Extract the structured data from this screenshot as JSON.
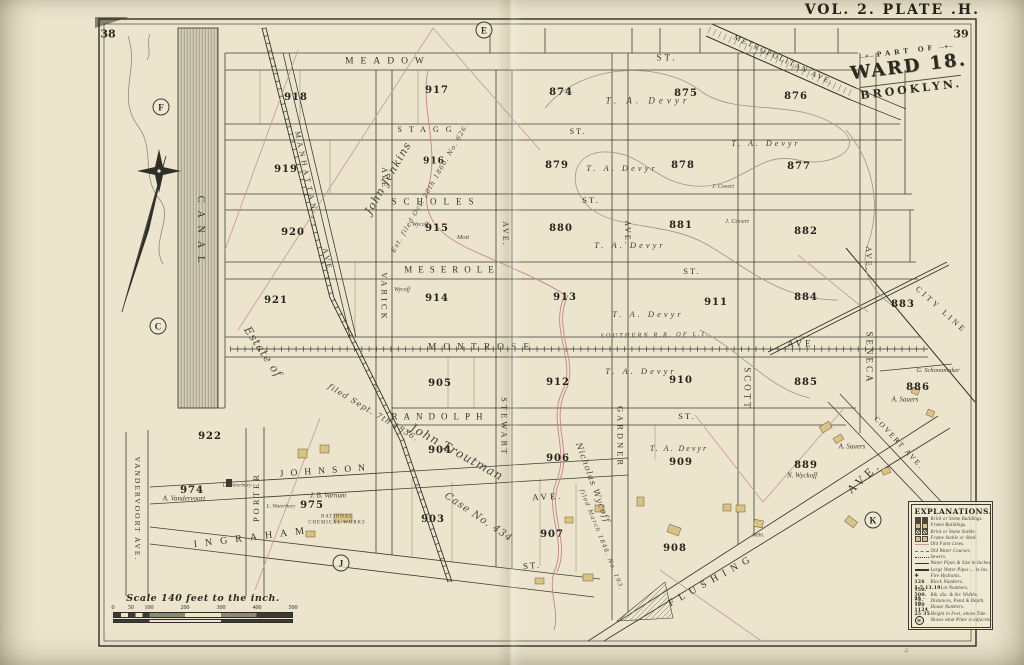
{
  "page": {
    "left_folio": "38",
    "right_folio": "39",
    "plate_title": "VOL. 2. PLATE .H.",
    "pencil_mark": "4"
  },
  "cartouche": {
    "part_of": "PART OF",
    "ward": "WARD 18.",
    "city": "BROOKLYN."
  },
  "scale_bar": {
    "label": "Scale 140 feet to the inch.",
    "ticks": [
      {
        "pos": 0,
        "t": "0"
      },
      {
        "pos": 10,
        "t": "50"
      },
      {
        "pos": 20,
        "t": "100"
      },
      {
        "pos": 40,
        "t": "200"
      },
      {
        "pos": 60,
        "t": "300"
      },
      {
        "pos": 80,
        "t": "400"
      },
      {
        "pos": 100,
        "t": "500"
      }
    ]
  },
  "explanations": {
    "title": "EXPLANATIONS.",
    "items": [
      {
        "sym": "brick",
        "label": "Brick or Stone Buildings."
      },
      {
        "sym": "frame",
        "label": "Frame Buildings."
      },
      {
        "sym": "brick-hatch",
        "label": "Brick or Stone Stable."
      },
      {
        "sym": "frame-hatch",
        "label": "Frame Stable or Shed."
      },
      {
        "sym": "farm",
        "label": "Old Farm Lines."
      },
      {
        "sym": "water",
        "label": "Old Water Courses."
      },
      {
        "sym": "sewer",
        "label": "Sewers."
      },
      {
        "sym": "pipe",
        "label": "Water Pipes & Size in Inches."
      },
      {
        "sym": "bigpipe",
        "label": "Large Water Pipes ... in Ins."
      },
      {
        "sym": "hydrant",
        "label": "Fire Hydrants."
      },
      {
        "sym": "text",
        "pre": "126",
        "label": "Block Numbers."
      },
      {
        "sym": "text",
        "pre": "5.7.13.19",
        "label": "Lot Numbers."
      },
      {
        "sym": "text",
        "pre": "150. 500. 75.",
        "label": "Blk. dia. & Str. Widths."
      },
      {
        "sym": "text",
        "pre": "25 · 10",
        "label": "Distances, Pond & Depth."
      },
      {
        "sym": "text",
        "pre": "120  1124",
        "label": "House Numbers."
      },
      {
        "sym": "text",
        "pre": "25  35",
        "label": "Height in Feet, above Tide."
      },
      {
        "sym": "plate",
        "pre": "H",
        "label": "Shows what Plate is adjacent."
      }
    ]
  },
  "plate_markers": [
    {
      "letter": "E",
      "x": 484,
      "y": 30
    },
    {
      "letter": "F",
      "x": 161,
      "y": 107
    },
    {
      "letter": "C",
      "x": 158,
      "y": 326
    },
    {
      "letter": "J",
      "x": 341,
      "y": 563
    },
    {
      "letter": "K",
      "x": 873,
      "y": 520
    }
  ],
  "map_labels": [
    {
      "t": "MEADOW",
      "x": 388,
      "y": 62,
      "s": 9.5,
      "ls": 7,
      "c": "street"
    },
    {
      "t": "ST.",
      "x": 667,
      "y": 58,
      "s": 9,
      "ls": 3,
      "c": "street"
    },
    {
      "t": "STAGG",
      "x": 428,
      "y": 130,
      "s": 8,
      "ls": 7,
      "c": "street"
    },
    {
      "t": "ST.",
      "x": 578,
      "y": 132,
      "s": 8,
      "ls": 2,
      "c": "street"
    },
    {
      "t": "SCHOLES",
      "x": 436,
      "y": 202,
      "s": 9,
      "ls": 7,
      "c": "street"
    },
    {
      "t": "ST.",
      "x": 591,
      "y": 200,
      "s": 8.5,
      "ls": 2,
      "c": "street"
    },
    {
      "t": "MESEROLE",
      "x": 452,
      "y": 270,
      "s": 9,
      "ls": 6,
      "c": "street"
    },
    {
      "t": "ST.",
      "x": 692,
      "y": 271,
      "s": 8.5,
      "ls": 2,
      "c": "street"
    },
    {
      "t": "MONTROSE",
      "x": 482,
      "y": 348,
      "s": 9.5,
      "ls": 7,
      "c": "street"
    },
    {
      "t": "AVE.",
      "x": 803,
      "y": 344,
      "s": 9,
      "ls": 3,
      "c": "street"
    },
    {
      "t": "SOUTHERN R.R. OF L.I.",
      "x": 655,
      "y": 336,
      "r": -1,
      "s": 6.5,
      "ls": 2,
      "c": "rr"
    },
    {
      "t": "RANDOLPH",
      "x": 440,
      "y": 417,
      "s": 9,
      "ls": 6,
      "c": "street"
    },
    {
      "t": "ST.",
      "x": 687,
      "y": 416,
      "s": 8.5,
      "ls": 2,
      "c": "street"
    },
    {
      "t": "JOHNSON",
      "x": 326,
      "y": 472,
      "r": -4,
      "s": 9.5,
      "ls": 7,
      "c": "street"
    },
    {
      "t": "AVE.",
      "x": 548,
      "y": 497,
      "r": -3,
      "s": 9,
      "ls": 3,
      "c": "street"
    },
    {
      "t": "INGRAHAM",
      "x": 253,
      "y": 538,
      "r": -7,
      "s": 10,
      "ls": 8,
      "c": "street"
    },
    {
      "t": "ST.",
      "x": 532,
      "y": 566,
      "r": -5,
      "s": 9,
      "ls": 2,
      "c": "street"
    },
    {
      "t": "FLUSHING",
      "x": 712,
      "y": 581,
      "r": -29,
      "s": 10,
      "ls": 6,
      "c": "street"
    },
    {
      "t": "AVE.",
      "x": 864,
      "y": 477,
      "r": -43,
      "s": 12,
      "ls": 4,
      "c": "street"
    },
    {
      "t": "MANHATTAN",
      "x": 306,
      "y": 172,
      "r": 78,
      "s": 7.5,
      "ls": 4,
      "c": "street"
    },
    {
      "t": "AVE.",
      "x": 328,
      "y": 262,
      "r": 78,
      "s": 7.5,
      "ls": 3,
      "c": "street"
    },
    {
      "t": "VARICK",
      "x": 384,
      "y": 297,
      "r": 90,
      "s": 8.5,
      "ls": 3,
      "c": "street"
    },
    {
      "t": "AVE.",
      "x": 384,
      "y": 180,
      "r": 90,
      "s": 8,
      "ls": 2,
      "c": "street"
    },
    {
      "t": "STEWART",
      "x": 504,
      "y": 427,
      "r": 90,
      "s": 8.5,
      "ls": 3,
      "c": "street"
    },
    {
      "t": "AVE.",
      "x": 505,
      "y": 234,
      "r": 90,
      "s": 8,
      "ls": 2,
      "c": "street"
    },
    {
      "t": "GARDNER",
      "x": 620,
      "y": 437,
      "r": 90,
      "s": 8.5,
      "ls": 3,
      "c": "street"
    },
    {
      "t": "AVE.",
      "x": 627,
      "y": 233,
      "r": 90,
      "s": 8,
      "ls": 2,
      "c": "street"
    },
    {
      "t": "SCOTT",
      "x": 747,
      "y": 389,
      "r": 90,
      "s": 9,
      "ls": 3,
      "c": "street"
    },
    {
      "t": "SENECA",
      "x": 869,
      "y": 358,
      "r": 90,
      "s": 9,
      "ls": 3,
      "c": "street"
    },
    {
      "t": "AVE.",
      "x": 868,
      "y": 259,
      "r": 90,
      "s": 8,
      "ls": 2,
      "c": "street"
    },
    {
      "t": "CITY LINE",
      "x": 941,
      "y": 310,
      "r": 42,
      "s": 8,
      "ls": 3,
      "c": "street"
    },
    {
      "t": "COVERT AVE.",
      "x": 899,
      "y": 443,
      "r": 47,
      "s": 7.5,
      "ls": 2,
      "c": "street"
    },
    {
      "t": "PORTER",
      "x": 256,
      "y": 497,
      "r": -90,
      "s": 8.5,
      "ls": 3,
      "c": "street"
    },
    {
      "t": "VANDERVOORT AVE.",
      "x": 137,
      "y": 509,
      "r": 90,
      "s": 7.5,
      "ls": 2,
      "c": "street"
    },
    {
      "t": "CANAL",
      "x": 200,
      "y": 233,
      "r": 90,
      "s": 10,
      "ls": 8,
      "c": "street"
    },
    {
      "t": "METROPOLITAN AVE.",
      "x": 784,
      "y": 60,
      "r": 25,
      "s": 7.5,
      "ls": 2,
      "c": "street"
    },
    {
      "t": "918",
      "x": 296,
      "y": 98,
      "s": 10,
      "c": "block"
    },
    {
      "t": "917",
      "x": 437,
      "y": 91,
      "s": 10,
      "c": "block"
    },
    {
      "t": "874",
      "x": 561,
      "y": 93,
      "s": 10,
      "c": "block"
    },
    {
      "t": "875",
      "x": 686,
      "y": 94,
      "s": 10,
      "c": "block"
    },
    {
      "t": "876",
      "x": 796,
      "y": 97,
      "s": 10,
      "c": "block"
    },
    {
      "t": "919",
      "x": 286,
      "y": 170,
      "s": 10,
      "c": "block"
    },
    {
      "t": "916",
      "x": 434,
      "y": 162,
      "s": 9,
      "c": "block"
    },
    {
      "t": "879",
      "x": 557,
      "y": 166,
      "s": 10,
      "c": "block"
    },
    {
      "t": "878",
      "x": 683,
      "y": 166,
      "s": 10,
      "c": "block"
    },
    {
      "t": "877",
      "x": 799,
      "y": 167,
      "s": 10,
      "c": "block"
    },
    {
      "t": "920",
      "x": 293,
      "y": 233,
      "s": 10,
      "c": "block"
    },
    {
      "t": "915",
      "x": 437,
      "y": 229,
      "s": 10,
      "c": "block"
    },
    {
      "t": "880",
      "x": 561,
      "y": 229,
      "s": 10,
      "c": "block"
    },
    {
      "t": "881",
      "x": 681,
      "y": 226,
      "s": 10,
      "c": "block"
    },
    {
      "t": "882",
      "x": 806,
      "y": 232,
      "s": 10,
      "c": "block"
    },
    {
      "t": "921",
      "x": 276,
      "y": 301,
      "s": 10,
      "c": "block"
    },
    {
      "t": "914",
      "x": 437,
      "y": 299,
      "s": 10,
      "c": "block"
    },
    {
      "t": "913",
      "x": 565,
      "y": 298,
      "s": 10,
      "c": "block"
    },
    {
      "t": "911",
      "x": 716,
      "y": 303,
      "s": 10,
      "c": "block"
    },
    {
      "t": "884",
      "x": 806,
      "y": 298,
      "s": 10,
      "c": "block"
    },
    {
      "t": "883",
      "x": 903,
      "y": 305,
      "s": 10,
      "c": "block"
    },
    {
      "t": "905",
      "x": 440,
      "y": 384,
      "s": 10,
      "c": "block"
    },
    {
      "t": "912",
      "x": 558,
      "y": 383,
      "s": 10,
      "c": "block"
    },
    {
      "t": "910",
      "x": 681,
      "y": 381,
      "s": 10,
      "c": "block"
    },
    {
      "t": "885",
      "x": 806,
      "y": 383,
      "s": 10,
      "c": "block"
    },
    {
      "t": "886",
      "x": 918,
      "y": 388,
      "s": 10,
      "c": "block"
    },
    {
      "t": "922",
      "x": 210,
      "y": 437,
      "s": 10,
      "c": "block"
    },
    {
      "t": "904",
      "x": 440,
      "y": 451,
      "s": 10,
      "c": "block"
    },
    {
      "t": "906",
      "x": 558,
      "y": 459,
      "s": 10,
      "c": "block"
    },
    {
      "t": "909",
      "x": 681,
      "y": 463,
      "s": 10,
      "c": "block"
    },
    {
      "t": "889",
      "x": 806,
      "y": 466,
      "s": 10,
      "c": "block"
    },
    {
      "t": "974",
      "x": 192,
      "y": 491,
      "s": 10,
      "c": "block"
    },
    {
      "t": "975",
      "x": 312,
      "y": 506,
      "s": 10,
      "c": "block"
    },
    {
      "t": "903",
      "x": 433,
      "y": 520,
      "s": 10,
      "c": "block"
    },
    {
      "t": "907",
      "x": 552,
      "y": 535,
      "s": 10,
      "c": "block"
    },
    {
      "t": "908",
      "x": 675,
      "y": 549,
      "s": 10,
      "c": "block"
    },
    {
      "t": "T. A. Devyr",
      "x": 648,
      "y": 101,
      "s": 9,
      "ls": 4,
      "c": "owner"
    },
    {
      "t": "T. A. Devyr",
      "x": 622,
      "y": 168,
      "s": 8.5,
      "ls": 3,
      "c": "owner"
    },
    {
      "t": "T. A. Devyr",
      "x": 766,
      "y": 144,
      "s": 8,
      "ls": 3,
      "c": "owner"
    },
    {
      "t": "J. Covert",
      "x": 723,
      "y": 187,
      "s": 6,
      "c": "tiny-i"
    },
    {
      "t": "T. A. Devyr",
      "x": 630,
      "y": 245,
      "s": 8.5,
      "ls": 3,
      "c": "owner"
    },
    {
      "t": "J. Covert",
      "x": 737,
      "y": 222,
      "s": 6.5,
      "c": "tiny-i"
    },
    {
      "t": "Wycoff",
      "x": 420,
      "y": 225,
      "s": 6,
      "c": "tiny-i"
    },
    {
      "t": "Mott",
      "x": 463,
      "y": 238,
      "s": 6.5,
      "c": "tiny-i"
    },
    {
      "t": "Wycoff",
      "x": 402,
      "y": 290,
      "s": 6,
      "c": "tiny-i"
    },
    {
      "t": "T. A. Devyr",
      "x": 648,
      "y": 314,
      "s": 8.5,
      "ls": 3,
      "c": "owner"
    },
    {
      "t": "T. A. Devyr",
      "x": 641,
      "y": 371,
      "s": 8.5,
      "ls": 3,
      "c": "owner"
    },
    {
      "t": "G. Schoonmaker",
      "x": 938,
      "y": 371,
      "s": 6.5,
      "c": "owner"
    },
    {
      "t": "A. Sauers",
      "x": 905,
      "y": 400,
      "s": 7,
      "c": "owner"
    },
    {
      "t": "T. A. Devyr",
      "x": 679,
      "y": 449,
      "s": 8,
      "ls": 2,
      "c": "owner"
    },
    {
      "t": "A. Sauers",
      "x": 852,
      "y": 447,
      "s": 7,
      "c": "owner"
    },
    {
      "t": "N. Wyckoff",
      "x": 802,
      "y": 476,
      "s": 7,
      "c": "owner"
    },
    {
      "t": "A. Vandervoort",
      "x": 184,
      "y": 499,
      "s": 7,
      "c": "owner"
    },
    {
      "t": "J. B. Varnum",
      "x": 328,
      "y": 496,
      "s": 7,
      "c": "owner"
    },
    {
      "t": "L. Waterbury",
      "x": 281,
      "y": 507,
      "s": 5.5,
      "c": "tiny-i"
    },
    {
      "t": "L. Waterbury",
      "x": 237,
      "y": 486,
      "s": 5.5,
      "c": "tiny-i"
    },
    {
      "t": "NATIONAL",
      "x": 337,
      "y": 518,
      "s": 4.8,
      "c": "works"
    },
    {
      "t": "CHEMICAL WORKS",
      "x": 337,
      "y": 524,
      "s": 4.8,
      "c": "works"
    },
    {
      "t": "3696.",
      "x": 758,
      "y": 536,
      "s": 5.5,
      "c": "tiny-i"
    },
    {
      "t": "John Jenkins",
      "x": 388,
      "y": 178,
      "r": -60,
      "s": 11,
      "c": "script"
    },
    {
      "t": "Est. filed Oct. 20th 1860. No. 626.",
      "x": 430,
      "y": 188,
      "r": -60,
      "s": 6.5,
      "c": "script"
    },
    {
      "t": "Estate of",
      "x": 263,
      "y": 352,
      "r": 56,
      "s": 11,
      "c": "script"
    },
    {
      "t": "filed Sept. 7th 1836.",
      "x": 373,
      "y": 413,
      "r": 31,
      "s": 8,
      "c": "script"
    },
    {
      "t": "John Troutman",
      "x": 457,
      "y": 452,
      "r": 29,
      "s": 12,
      "c": "script"
    },
    {
      "t": "Case No. 434.",
      "x": 480,
      "y": 519,
      "r": 34,
      "s": 10,
      "c": "script"
    },
    {
      "t": "Nicholas Wycoff",
      "x": 592,
      "y": 483,
      "r": 70,
      "s": 8.5,
      "c": "script"
    },
    {
      "t": "filed March 1848. No. 193.",
      "x": 601,
      "y": 540,
      "r": 68,
      "s": 6,
      "c": "script"
    },
    {
      "t": "4",
      "x": 906,
      "y": 651,
      "s": 8,
      "c": "pencil"
    }
  ],
  "colors": {
    "paper": "#ece4cd",
    "ink": "#3b3a32",
    "farm_line": "#c9989e",
    "frame_building": "#d9c285",
    "brick_building": "#3c3a33"
  }
}
